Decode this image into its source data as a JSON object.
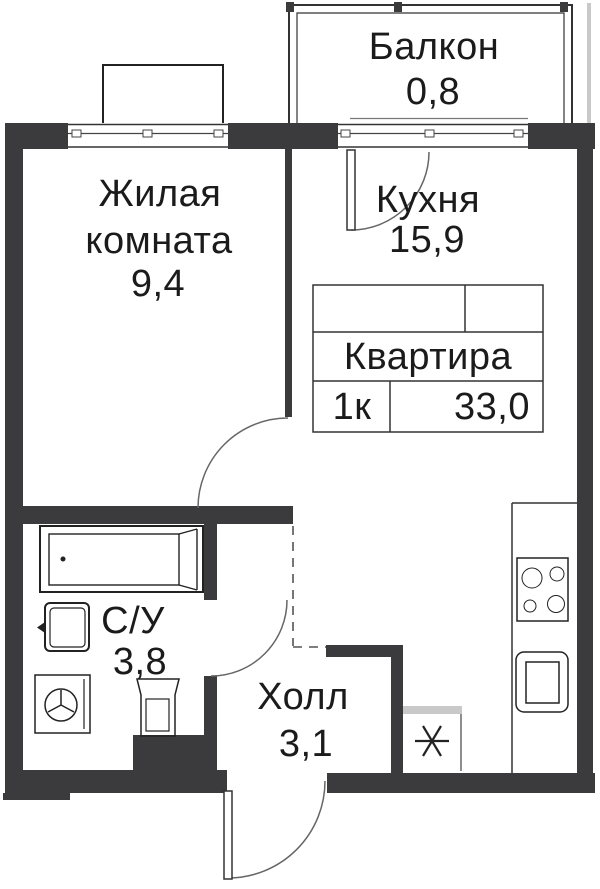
{
  "plan_summary": {
    "label": "Квартира",
    "rooms_value": "1к",
    "total_area": "33,0"
  },
  "rooms": {
    "balcony": {
      "name": "Балкон",
      "area": "0,8"
    },
    "living": {
      "name_line1": "Жилая",
      "name_line2": "комната",
      "area": "9,4"
    },
    "kitchen": {
      "name": "Кухня",
      "area": "15,9"
    },
    "bathroom": {
      "name": "С/У",
      "area": "3,8"
    },
    "hall": {
      "name": "Холл",
      "area": "3,1"
    }
  },
  "fixtures": [
    "bathtub",
    "wash-basin",
    "washing-machine",
    "toilet",
    "stove",
    "kitchen-sink",
    "ventilation-shaft"
  ],
  "colors": {
    "wall": "#3b3b3d",
    "line": "#1f1f1f",
    "accent_gray": "#c9c9c9"
  }
}
